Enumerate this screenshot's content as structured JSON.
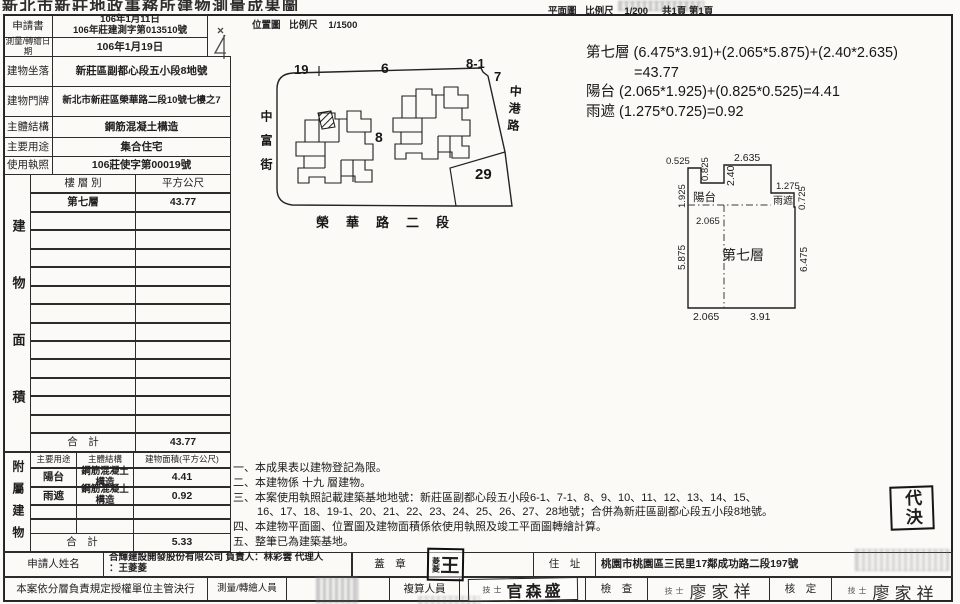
{
  "colors": {
    "ink": "#1f1f1f",
    "paper": "#fbfaf7"
  },
  "header": {
    "doc_title": "新北市新莊地政事務所建物測量成果圖",
    "site_map_title": "位置圖",
    "site_map_scale_label": "比例尺",
    "site_map_scale": "1/1500",
    "plan_title": "平面圖",
    "plan_scale_label": "比例尺",
    "plan_scale": "1/200",
    "page_info": "共1頁 第1頁"
  },
  "info_table": {
    "rows": [
      {
        "label": "申請書",
        "line1": "106年1月11日",
        "line2": "106年莊建測字第013510號"
      },
      {
        "label": "測量/轉繪日期",
        "value": "106年1月19日"
      },
      {
        "label": "建物坐落",
        "value": "新莊區副都心段五小段8地號"
      },
      {
        "label": "建物門牌",
        "value": "新北市新莊區榮華路二段10號七樓之7"
      },
      {
        "label": "主體結構",
        "value": "鋼筋混凝土構造"
      },
      {
        "label": "主要用途",
        "value": "集合住宅"
      },
      {
        "label": "使用執照",
        "value": "106莊使字第00019號"
      }
    ]
  },
  "floor_table": {
    "side_label": "建物面積",
    "col_floor": "樓 層 別",
    "col_area": "平方公尺",
    "floor": "第七層",
    "area": "43.77",
    "total_label": "合　計",
    "total": "43.77"
  },
  "annex_table": {
    "side_label": "附屬建物",
    "col_use": "主要用途",
    "col_structure": "主體結構",
    "col_area": "建物面積(平方公尺)",
    "rows": [
      {
        "use": "陽台",
        "structure": "鋼筋混凝土構造",
        "area": "4.41"
      },
      {
        "use": "雨遮",
        "structure": "鋼筋混凝土構造",
        "area": "0.92"
      }
    ],
    "total_label": "合　計",
    "total": "5.33"
  },
  "site_map": {
    "p19": "19",
    "p6": "6",
    "p8_1": "8-1",
    "p7": "7",
    "p8": "8",
    "p29": "29",
    "street_west": "中富街",
    "street_east": "中港路",
    "street_south": "榮華路二段"
  },
  "calc": {
    "line1": "第七層 (6.475*3.91)+(2.065*5.875)+(2.40*2.635)",
    "line2": "=43.77",
    "line3": "陽台 (2.065*1.925)+(0.825*0.525)=4.41",
    "line4": "雨遮 (1.275*0.725)=0.92"
  },
  "floor_plan": {
    "balcony": "陽台",
    "canopy": "雨遮",
    "room": "第七層",
    "d0525": "0.525",
    "d0825": "0.825",
    "d2635": "2.635",
    "d240": "2.40",
    "d1275": "1.275",
    "d0725": "0.725",
    "d1925": "1.925",
    "d2065_top": "2.065",
    "d5875": "5.875",
    "d6475": "6.475",
    "d2065_bottom": "2.065",
    "d391": "3.91"
  },
  "notes": {
    "n1": "一、本成果表以建物登記為限。",
    "n2": "二、本建物係 十九 層建物。",
    "n3": "三、本案使用執照記載建築基地地號：新莊區副都心段五小段6-1、7-1、8、9、10、11、12、13、14、15、",
    "n3b": "16、17、18、19-1、20、21、22、23、24、25、26、27、28地號；合併為新莊區副都心段五小段8地號。",
    "n4": "四、本建物平面圖、位置圖及建物面積係依使用執照及竣工平面圖轉繪計算。",
    "n5": "五、整筆已為建築基地。"
  },
  "footer": {
    "applicant_label": "申請人姓名",
    "applicant_line1": "合輝建設開發股份有限公司 負責人：林彩雲 代理人",
    "applicant_line2": "：王菱菱",
    "seal_label": "蓋　章",
    "address_label": "住　址",
    "address_value": "桃園市桃園區三民里17鄰成功路二段197號",
    "authority_note": "本案依分層負責規定授權單位主管決行",
    "surveyor_label": "測量/轉繪人員",
    "checker_label": "複算人員",
    "inspect_label": "檢　查",
    "approve_label": "核　定"
  },
  "stamps": {
    "applicant_seal_big": "王",
    "applicant_seal_small": "菱菱",
    "surveyor_title": "技士",
    "surveyor_name": "官森盛",
    "inspector_title": "技士",
    "inspector_name": "廖家祥",
    "approver_title": "技士",
    "approver_name": "廖家祥",
    "delegate": "代決"
  }
}
